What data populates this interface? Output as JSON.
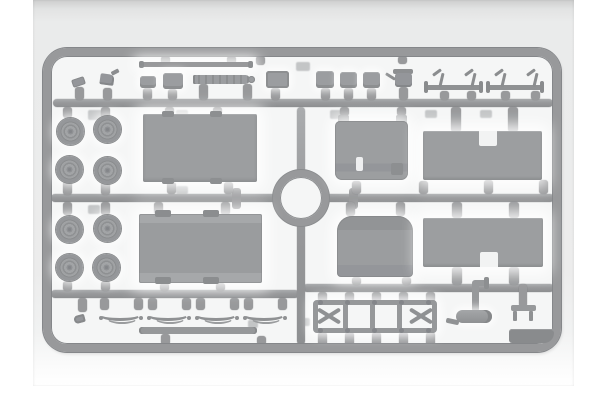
{
  "scene": {
    "type": "product-photo",
    "subject": "Injection-molded plastic model kit sprue",
    "alt": "Light gray plastic sprue frame photographed on a pale gradient background. The sprue holds truck model parts: eight wheels, two large cargo-bed panels, two roof panels with rectangular cutouts, a cab floor, a rounded cab hood, four leaf springs, a ladder chassis frame, two axles with steering arms, a muffler with exhaust pipe, small blocks, strips and fittings, arranged around a circular ring at the center of the runners."
  },
  "colors": {
    "page_bg": "#ffffff",
    "photo_bg": "#ececec",
    "photo_bg_top": "#cdcece",
    "photo_bg_bottom": "#ffffff",
    "interior_bg": "#f5f6f6",
    "sprue": "#98999b",
    "sprue_dark": "#85878a",
    "part": "#9b9da0",
    "panel": "#9c9ea0",
    "part_dark": "#8b8d8f",
    "part_light": "#a6a8aa",
    "ghost": "#b7b9bb",
    "notch": "#f2f3f3"
  },
  "sprue": {
    "frame": {
      "x": 43,
      "y": 48,
      "w": 518,
      "h": 304,
      "radius": 24,
      "thickness": 8
    },
    "ring": {
      "cx": 301,
      "cy": 198,
      "outer_d": 56,
      "thickness": 7
    },
    "runners": [
      {
        "x": 53,
        "y": 99,
        "w": 500,
        "h": 8
      },
      {
        "x": 51,
        "y": 194,
        "w": 226,
        "h": 8
      },
      {
        "x": 324,
        "y": 194,
        "w": 230,
        "h": 8
      },
      {
        "x": 51,
        "y": 290,
        "w": 248,
        "h": 8
      },
      {
        "x": 303,
        "y": 284,
        "w": 251,
        "h": 8
      },
      {
        "x": 297,
        "y": 107,
        "w": 8,
        "h": 238
      }
    ],
    "cross_tabs": [
      {
        "x": 232,
        "y": 188,
        "w": 9,
        "h": 21
      },
      {
        "x": 349,
        "y": 188,
        "w": 9,
        "h": 21
      }
    ],
    "gates": [
      {
        "x": 75,
        "y": 87,
        "h": 13
      },
      {
        "x": 103,
        "y": 88,
        "h": 12
      },
      {
        "x": 143,
        "y": 88,
        "h": 12
      },
      {
        "x": 168,
        "y": 89,
        "h": 11
      },
      {
        "x": 199,
        "y": 84,
        "h": 16
      },
      {
        "x": 243,
        "y": 84,
        "h": 16
      },
      {
        "x": 271,
        "y": 88,
        "h": 12
      },
      {
        "x": 161,
        "y": 56,
        "h": 8
      },
      {
        "x": 227,
        "y": 56,
        "h": 8
      },
      {
        "x": 256,
        "y": 56,
        "h": 9
      },
      {
        "x": 321,
        "y": 88,
        "h": 12
      },
      {
        "x": 344,
        "y": 88,
        "h": 12
      },
      {
        "x": 367,
        "y": 88,
        "h": 12
      },
      {
        "x": 398,
        "y": 56,
        "h": 8
      },
      {
        "x": 399,
        "y": 87,
        "h": 13
      },
      {
        "x": 440,
        "y": 91,
        "h": 9
      },
      {
        "x": 467,
        "y": 91,
        "h": 9
      },
      {
        "x": 501,
        "y": 91,
        "h": 9
      },
      {
        "x": 531,
        "y": 91,
        "h": 9
      },
      {
        "x": 63,
        "y": 107,
        "h": 11
      },
      {
        "x": 101,
        "y": 107,
        "h": 11
      },
      {
        "x": 165,
        "y": 107,
        "h": 8
      },
      {
        "x": 213,
        "y": 107,
        "h": 8
      },
      {
        "x": 340,
        "y": 107,
        "h": 9
      },
      {
        "x": 397,
        "y": 107,
        "h": 9
      },
      {
        "x": 451,
        "y": 107,
        "w": 10,
        "h": 25
      },
      {
        "x": 508,
        "y": 107,
        "w": 10,
        "h": 25
      },
      {
        "x": 63,
        "y": 181,
        "h": 14
      },
      {
        "x": 101,
        "y": 181,
        "h": 14
      },
      {
        "x": 167,
        "y": 182,
        "h": 12
      },
      {
        "x": 224,
        "y": 182,
        "h": 12
      },
      {
        "x": 352,
        "y": 181,
        "h": 13
      },
      {
        "x": 419,
        "y": 181,
        "h": 13
      },
      {
        "x": 484,
        "y": 180,
        "h": 14
      },
      {
        "x": 539,
        "y": 180,
        "h": 14
      },
      {
        "x": 63,
        "y": 202,
        "h": 13
      },
      {
        "x": 101,
        "y": 202,
        "h": 13
      },
      {
        "x": 154,
        "y": 202,
        "h": 13
      },
      {
        "x": 221,
        "y": 202,
        "h": 13
      },
      {
        "x": 346,
        "y": 202,
        "h": 14
      },
      {
        "x": 396,
        "y": 202,
        "h": 14
      },
      {
        "x": 452,
        "y": 202,
        "w": 10,
        "h": 16
      },
      {
        "x": 509,
        "y": 202,
        "w": 10,
        "h": 16
      },
      {
        "x": 63,
        "y": 281,
        "h": 10
      },
      {
        "x": 101,
        "y": 281,
        "h": 10
      },
      {
        "x": 160,
        "y": 283,
        "h": 8
      },
      {
        "x": 216,
        "y": 283,
        "h": 8
      },
      {
        "x": 352,
        "y": 277,
        "h": 8
      },
      {
        "x": 402,
        "y": 277,
        "h": 8
      },
      {
        "x": 452,
        "y": 267,
        "w": 10,
        "h": 18
      },
      {
        "x": 509,
        "y": 267,
        "w": 10,
        "h": 18
      },
      {
        "x": 78,
        "y": 298,
        "h": 14
      },
      {
        "x": 100,
        "y": 298,
        "h": 12
      },
      {
        "x": 134,
        "y": 298,
        "h": 12
      },
      {
        "x": 148,
        "y": 298,
        "h": 12
      },
      {
        "x": 182,
        "y": 298,
        "h": 12
      },
      {
        "x": 196,
        "y": 298,
        "h": 12
      },
      {
        "x": 230,
        "y": 298,
        "h": 12
      },
      {
        "x": 244,
        "y": 298,
        "h": 12
      },
      {
        "x": 278,
        "y": 298,
        "h": 12
      },
      {
        "x": 161,
        "y": 334,
        "h": 11
      },
      {
        "x": 257,
        "y": 336,
        "h": 9
      },
      {
        "x": 318,
        "y": 292,
        "h": 10
      },
      {
        "x": 345,
        "y": 292,
        "h": 10
      },
      {
        "x": 372,
        "y": 292,
        "h": 10
      },
      {
        "x": 399,
        "y": 292,
        "h": 10
      },
      {
        "x": 426,
        "y": 292,
        "h": 10
      },
      {
        "x": 318,
        "y": 332,
        "h": 14
      },
      {
        "x": 345,
        "y": 332,
        "h": 14
      },
      {
        "x": 372,
        "y": 332,
        "h": 14
      },
      {
        "x": 399,
        "y": 332,
        "h": 14
      },
      {
        "x": 426,
        "y": 332,
        "h": 14
      },
      {
        "x": 519,
        "y": 284,
        "w": 8,
        "h": 23
      }
    ],
    "ghosts": [
      [
        88,
        110,
        14,
        10
      ],
      [
        176,
        110,
        12,
        9
      ],
      [
        296,
        62,
        14,
        9
      ],
      [
        330,
        110,
        12,
        9
      ],
      [
        425,
        110,
        12,
        8
      ],
      [
        480,
        110,
        12,
        8
      ],
      [
        248,
        320,
        10,
        8
      ],
      [
        88,
        205,
        12,
        9
      ],
      [
        300,
        318,
        10,
        8
      ],
      [
        176,
        186,
        12,
        8
      ]
    ]
  },
  "parts": {
    "wheels": {
      "count": 8,
      "r": 13.5,
      "centers": [
        [
          70,
          131
        ],
        [
          107,
          129
        ],
        [
          69,
          169
        ],
        [
          107,
          170
        ],
        [
          69,
          229
        ],
        [
          107,
          228
        ],
        [
          69,
          267
        ],
        [
          106,
          267
        ]
      ]
    },
    "leaf_springs": {
      "count": 4,
      "positions": [
        [
          99,
          309
        ],
        [
          147,
          309
        ],
        [
          195,
          309
        ],
        [
          243,
          309
        ]
      ]
    },
    "blocks": [
      {
        "x": 140,
        "y": 76,
        "w": 16,
        "h": 12
      },
      {
        "x": 163,
        "y": 73,
        "w": 20,
        "h": 16
      },
      {
        "x": 316,
        "y": 71,
        "w": 18,
        "h": 17
      },
      {
        "x": 340,
        "y": 72,
        "w": 17,
        "h": 16
      },
      {
        "x": 363,
        "y": 72,
        "w": 17,
        "h": 16
      }
    ],
    "axles": {
      "bars": [
        {
          "x": 424,
          "y": 85,
          "w": 59,
          "h": 5
        },
        {
          "x": 486,
          "y": 85,
          "w": 57,
          "h": 5
        }
      ],
      "caps_x": [
        424,
        479,
        486,
        540
      ],
      "cap_y": 81,
      "cap_w": 4,
      "cap_h": 12,
      "arms": [
        [
          431,
          70
        ],
        [
          463,
          70
        ],
        [
          493,
          70
        ],
        [
          525,
          70
        ]
      ]
    },
    "chassis": {
      "crossmember_offsets": [
        25,
        52,
        79
      ],
      "x_brace_cells": "both ends",
      "studs": [
        [
          318,
          300
        ],
        [
          345,
          300
        ],
        [
          372,
          300
        ],
        [
          399,
          300
        ],
        [
          426,
          300
        ],
        [
          318,
          328
        ],
        [
          345,
          328
        ],
        [
          372,
          328
        ],
        [
          399,
          328
        ],
        [
          426,
          328
        ]
      ]
    }
  }
}
